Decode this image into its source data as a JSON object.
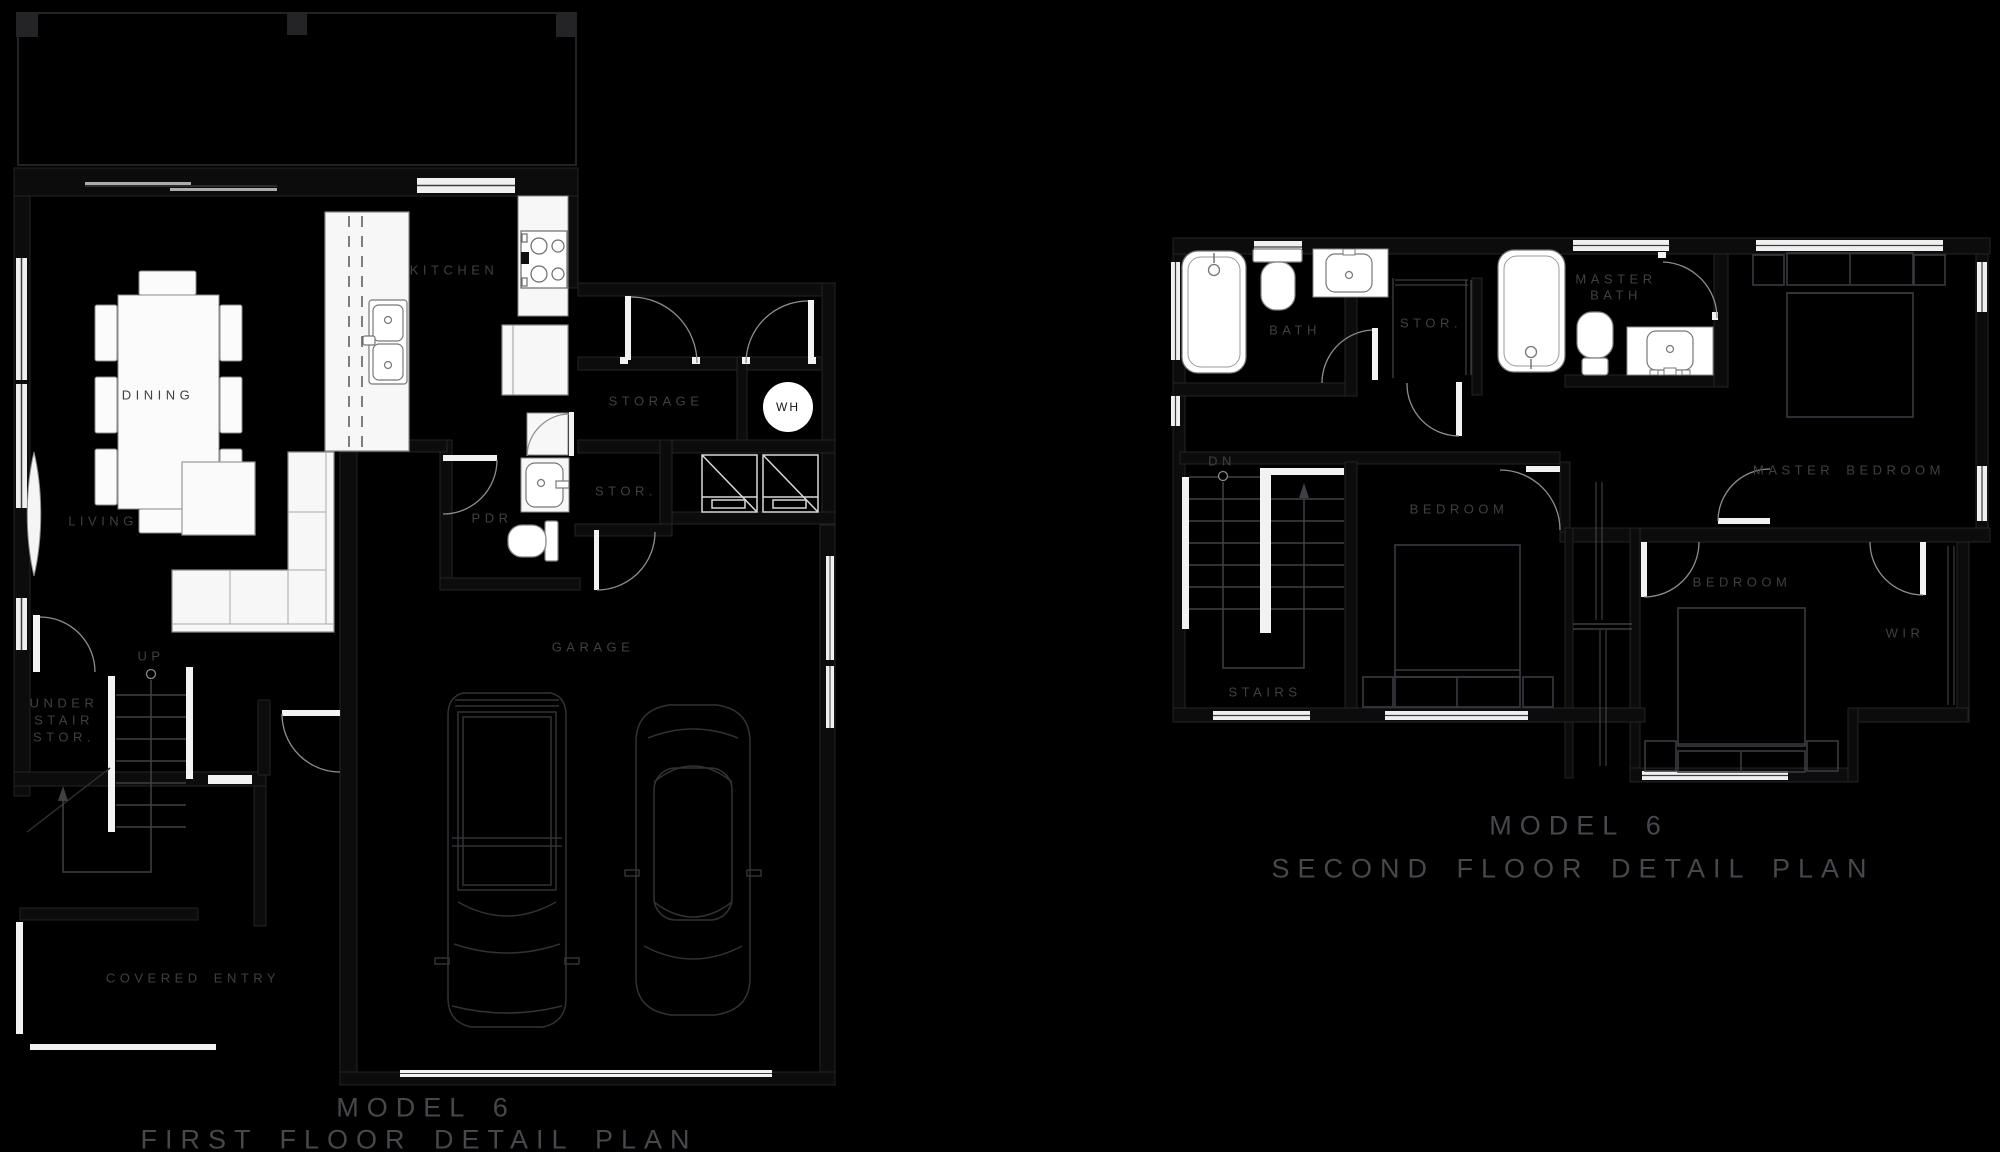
{
  "colors": {
    "background": "#000000",
    "room_label": "#3f4043",
    "title_text": "#47484b",
    "fixture_fill": "#f7f7f8",
    "fixture_outline": "#77777a",
    "furniture_outline": "#323236",
    "bed_outline": "#3a3b3f",
    "door_arc": "#8e8e8f",
    "wall_hairline": "#232326"
  },
  "first_floor": {
    "title": {
      "line1": "MODEL 6",
      "line2": "FIRST FLOOR DETAIL PLAN"
    },
    "labels": {
      "dining": "DINING",
      "kitchen": "KITCHEN",
      "living": "LIVING",
      "up": "UP",
      "under_stair_stor": [
        "UNDER",
        "STAIR",
        "STOR."
      ],
      "storage": "STORAGE",
      "water_heater": "WH",
      "stor": "STOR.",
      "pdr": "PDR",
      "garage": "GARAGE",
      "covered_entry": "COVERED ENTRY"
    }
  },
  "second_floor": {
    "title": {
      "line1": "MODEL 6",
      "line2": "SECOND FLOOR DETAIL PLAN"
    },
    "labels": {
      "bath": "BATH",
      "stor": "STOR.",
      "master_bath": [
        "MASTER",
        "BATH"
      ],
      "master_bedroom": "MASTER BEDROOM",
      "dn": "DN",
      "stairs": "STAIRS",
      "bedroom_left": "BEDROOM",
      "bedroom_right": "BEDROOM",
      "wir": "WIR"
    }
  }
}
